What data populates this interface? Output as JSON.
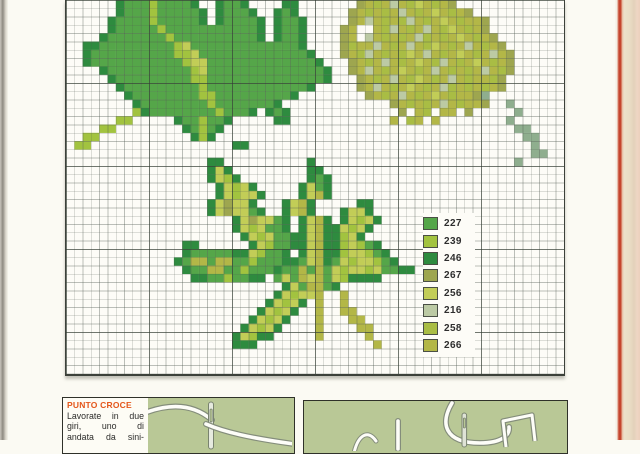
{
  "page": {
    "kind": "cross-stitch pattern page",
    "background": "#fbfaf3",
    "edge_colors": {
      "left_strip": "#8f8b82",
      "right_rule": "#c5452e",
      "right_paper": "#ece1cb"
    }
  },
  "legend": {
    "items": [
      {
        "code": "227",
        "color": "#55a649"
      },
      {
        "code": "239",
        "color": "#a2c33f"
      },
      {
        "code": "246",
        "color": "#2e8b3f"
      },
      {
        "code": "267",
        "color": "#9ea64f"
      },
      {
        "code": "256",
        "color": "#c2cd57"
      },
      {
        "code": "216",
        "color": "#bccaa4"
      },
      {
        "code": "258",
        "color": "#a9bd44"
      },
      {
        "code": "266",
        "color": "#b3b747"
      }
    ]
  },
  "chart_data": {
    "type": "heatmap",
    "title": "Leaf cross-stitch chart (maple leaf top-left, poplar leaf with stem top-right, horse-chestnut leaf bottom-center)",
    "grid": {
      "cols": 60,
      "rows": 45,
      "cell_px": 8.3
    },
    "palette": {
      "A": "#55a649",
      "B": "#a2c33f",
      "C": "#2e8b3f",
      "D": "#9ea64f",
      "E": "#c2cd57",
      "F": "#bccaa4",
      "G": "#a9bd44",
      "H": "#b3b747",
      "S": "#8fae8e"
    },
    "rows": [
      "......CAAABAAAAC..CAAC....CC.......DHGHFHGEHGHD.............",
      "......CAAABAAAAAC.CAAAC..CAC......DHGHGHFHGHEHGHD...........",
      ".....CAAAABAAAAAC.CAAAAC.CAAC.....DHFHGHGFHGHEHGHHD.........",
      ".....CAAAAABAAAAAAAAAAAC.CAAC....DH..HGFHGHFHGEHGHD.........",
      "....CAAAAAAABAAAAAAAAAAC.CAAC....DH.FHGHGHFGHGHEHGHD........",
      "..CCAAAAAAAAABEAAAAAAAAAAAAAC....DGHHFHGHFHGEHGHFHGHD.......",
      "..CAAAAAAAAAABBEAAAAAAAAAAAAAC...DHGFHGHGEHFHGHEHGHFHD......",
      "..CAAAAAAAAAAABEEAAAAAAAAAAAAAC...DHGHFHGHEHGFHGHEHGHD......",
      "....CAAAAAAAAAABEAAAAAAAAAAAAAAC..DHFHGHEHGHFHGHGHFHGD......",
      ".....CAAAAAAAAABBAAAAAAAAAAAAAAC...DHGHFHGEHGHFHGHHGD.......",
      "......CAAAAAAAAABAAAAAAAAAAAAC.....DHFHGHEHGHFGHGHGHD.......",
      ".......CAAAAAAAABBAAAAAAAAAC........DHGHFHGHEHGHHDS.........",
      "........CAAAAAAAABAAAAAAAC.............DHGHGHFHGHHD..S......",
      "........BCAAAAAAAABAAAC.CAC.............D.HG.HH.D.....S.....",
      "......BB.....CAABAAC.....CC............H.GH.H........S......",
      "....BB........CABAC...................................SS....",
      "..BB...........CBC.....................................SS...",
      ".BB.................CC..................................S...",
      "........................................................SS..",
      ".................CC..........C........................S.....",
      ".................CEC.........CC.............................",
      ".................CEBC........CAC............................",
      "..................CEBEC.....CEAC............................",
      "..................CEBEEC....CEHC............................",
      ".................CEDEEC...CEHC.....CC.......................",
      ".................CEDEEAC..CEHC...CEEC.......................",
      "....................CEDEEAC.CEHC.CEBEC......................",
      "....................CEBEAAC.CEHCCEBEC.......................",
      ".....................CEBEAACCEHCCBEC........................",
      "..............CC......CEBAACCEHCCBEBAC......................",
      "..............CAAAAACCEBAAC.CEHCCBEEBAC.....................",
      ".............CAHHAHHAABAAACCAEHCAEBEEBAC....................",
      "..............CAAHHAABAAACAAHAHAEBEEBEAACC..................",
      "...............CCAABAACC.AEAHEHAEBCCCC......................",
      "..........................CEAHHAC...........................",
      ".........................CEBEEH..H..........................",
      "........................CEBEC.H..H..........................",
      ".......................CEBEC..H..HH.........................",
      "......................CEBEC...H...HH........................",
      ".....................CEBEC....H....HH.......................",
      "....................CEBCC.....H.....H.......................",
      "....................CCC..............H......................",
      "............................................................",
      "............................................................",
      "............................................................"
    ]
  },
  "instructions": {
    "title": "PUNTO CROCE",
    "title_color": "#e4571b",
    "lines": [
      "Lavorate in due",
      "giri, uno di",
      "andata da sini-"
    ]
  }
}
